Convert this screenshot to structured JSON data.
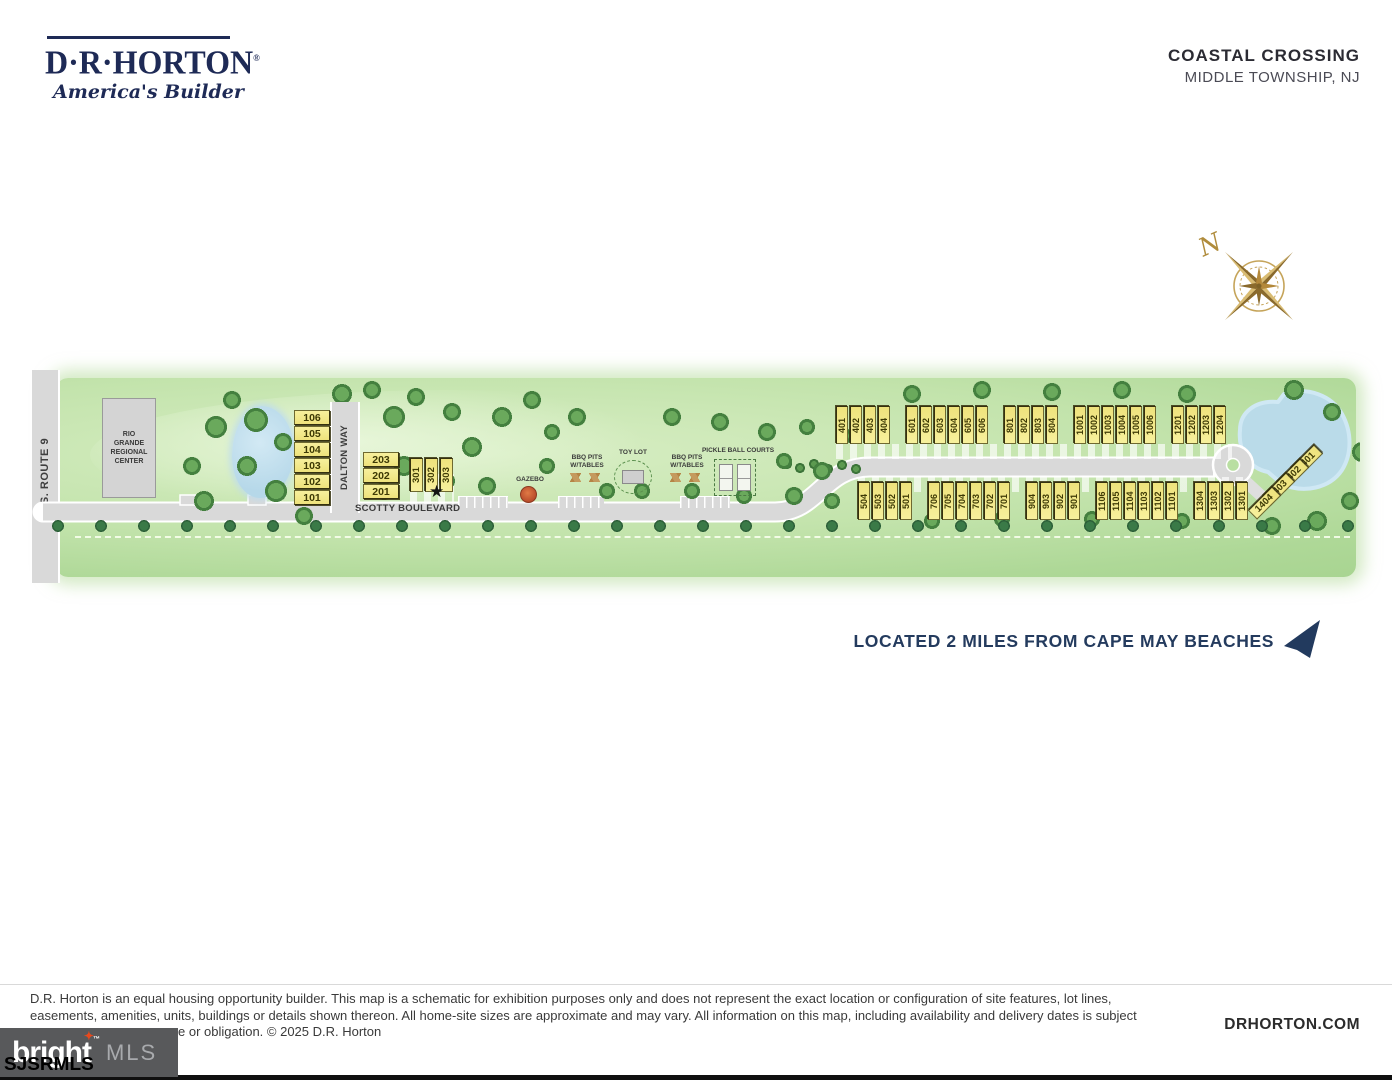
{
  "header": {
    "builder_logo": {
      "name": "D·R·HORTON",
      "registered": "®",
      "tagline": "America's Builder"
    },
    "community_title": "COASTAL CROSSING",
    "community_location": "MIDDLE TOWNSHIP, NJ"
  },
  "compass": {
    "north_label": "N"
  },
  "map": {
    "roads": {
      "route_9": "U.S. ROUTE 9",
      "dalton_way": "DALTON WAY",
      "scotty_boulevard": "SCOTTY BOULEVARD"
    },
    "building_label": "RIO GRANDE REGIONAL CENTER",
    "amenities": {
      "gazebo": "GAZEBO",
      "bbq_pits": "BBQ PITS W/TABLES",
      "toy_lot": "TOY LOT",
      "pickleball": "PICKLE BALL COURTS"
    },
    "icons": {
      "star_marker": "★"
    },
    "lots": {
      "dalton_west": [
        "106",
        "105",
        "104",
        "103",
        "102",
        "101"
      ],
      "dalton_east": [
        "203",
        "202",
        "201"
      ],
      "row_300": [
        "301",
        "302",
        "303"
      ],
      "north_groups": [
        [
          "401",
          "402",
          "403",
          "404"
        ],
        [
          "601",
          "602",
          "603",
          "604",
          "605",
          "606"
        ],
        [
          "801",
          "802",
          "803",
          "804"
        ],
        [
          "1001",
          "1002",
          "1003",
          "1004",
          "1005",
          "1006"
        ],
        [
          "1201",
          "1202",
          "1203",
          "1204"
        ]
      ],
      "south_groups": [
        [
          "504",
          "503",
          "502",
          "501"
        ],
        [
          "706",
          "705",
          "704",
          "703",
          "702",
          "701"
        ],
        [
          "904",
          "903",
          "902",
          "901"
        ],
        [
          "1106",
          "1105",
          "1104",
          "1103",
          "1102",
          "1101"
        ],
        [
          "1304",
          "1303",
          "1302",
          "1301"
        ]
      ],
      "cul_de_sac_group": [
        "1401",
        "1402",
        "1403",
        "1404"
      ]
    }
  },
  "beach_note": {
    "text": "LOCATED 2 MILES FROM CAPE MAY BEACHES"
  },
  "footer": {
    "disclaimer_lines": [
      "D.R. Horton is an equal housing opportunity builder. This map is a schematic for exhibition purposes only and does not represent the exact location or configuration of site features, lot lines,",
      "easements, amenities, units, buildings or details shown thereon. All home-site sizes are approximate and may vary. All information on this map, including availability and delivery dates is subject",
      "e or obligation. © 2025 D.R. Horton"
    ],
    "website": "DRHORTON.COM",
    "mls_logo": {
      "bright": "bright",
      "tm": "™",
      "mls": "MLS",
      "sparkle": "✦"
    },
    "watermark": "SJSRMLS"
  },
  "colors": {
    "navy": "#1e2a56",
    "green_base": "#b7dda0",
    "road_gray": "#d9d9d9",
    "lot_yellow": "#f3e98c",
    "pond_blue": "#bcdcec",
    "compass_gold": "#b3883a",
    "mls_gray": "#58595b",
    "mls_orange": "#e8491d"
  }
}
